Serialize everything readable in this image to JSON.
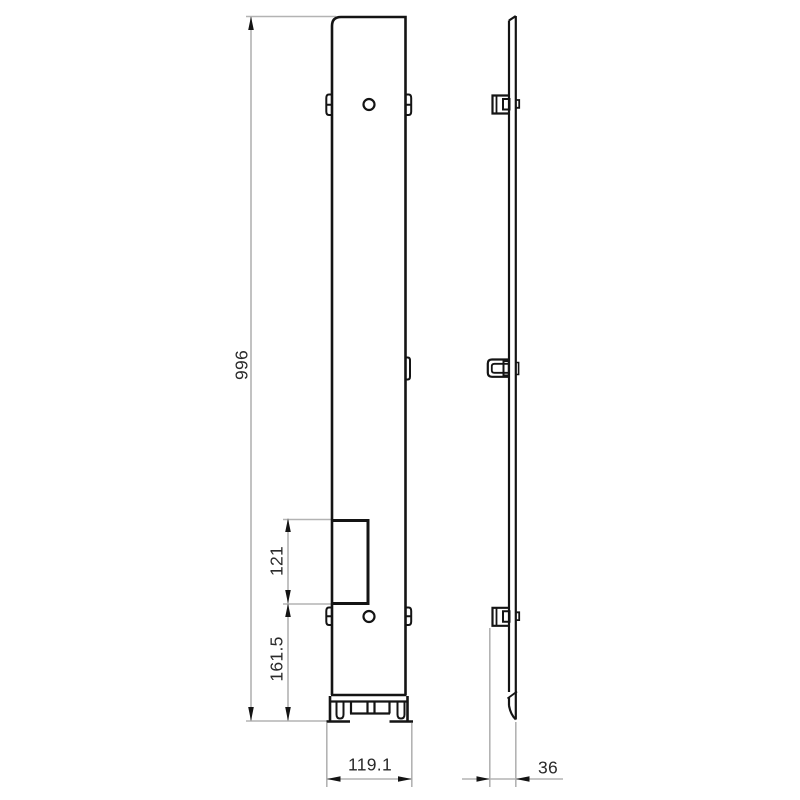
{
  "drawing": {
    "type": "technical-drawing",
    "description": "Two orthographic views of a tall mounting plate: front view (left) and side profile view (right)",
    "background_color": "#ffffff",
    "outline_color": "#141414",
    "dimension_line_color": "#b3b3b3",
    "dimension_text_color": "#2a2a2a",
    "views": {
      "front": {
        "name": "front-view"
      },
      "side": {
        "name": "side-view"
      }
    },
    "dimensions": {
      "overall_height": {
        "value": "996",
        "orientation": "vertical"
      },
      "cutout_height": {
        "value": "121",
        "orientation": "vertical"
      },
      "bottom_section_height": {
        "value": "161.5",
        "orientation": "vertical"
      },
      "front_width": {
        "value": "119.1",
        "orientation": "horizontal"
      },
      "side_depth": {
        "value": "36",
        "orientation": "horizontal"
      }
    }
  }
}
